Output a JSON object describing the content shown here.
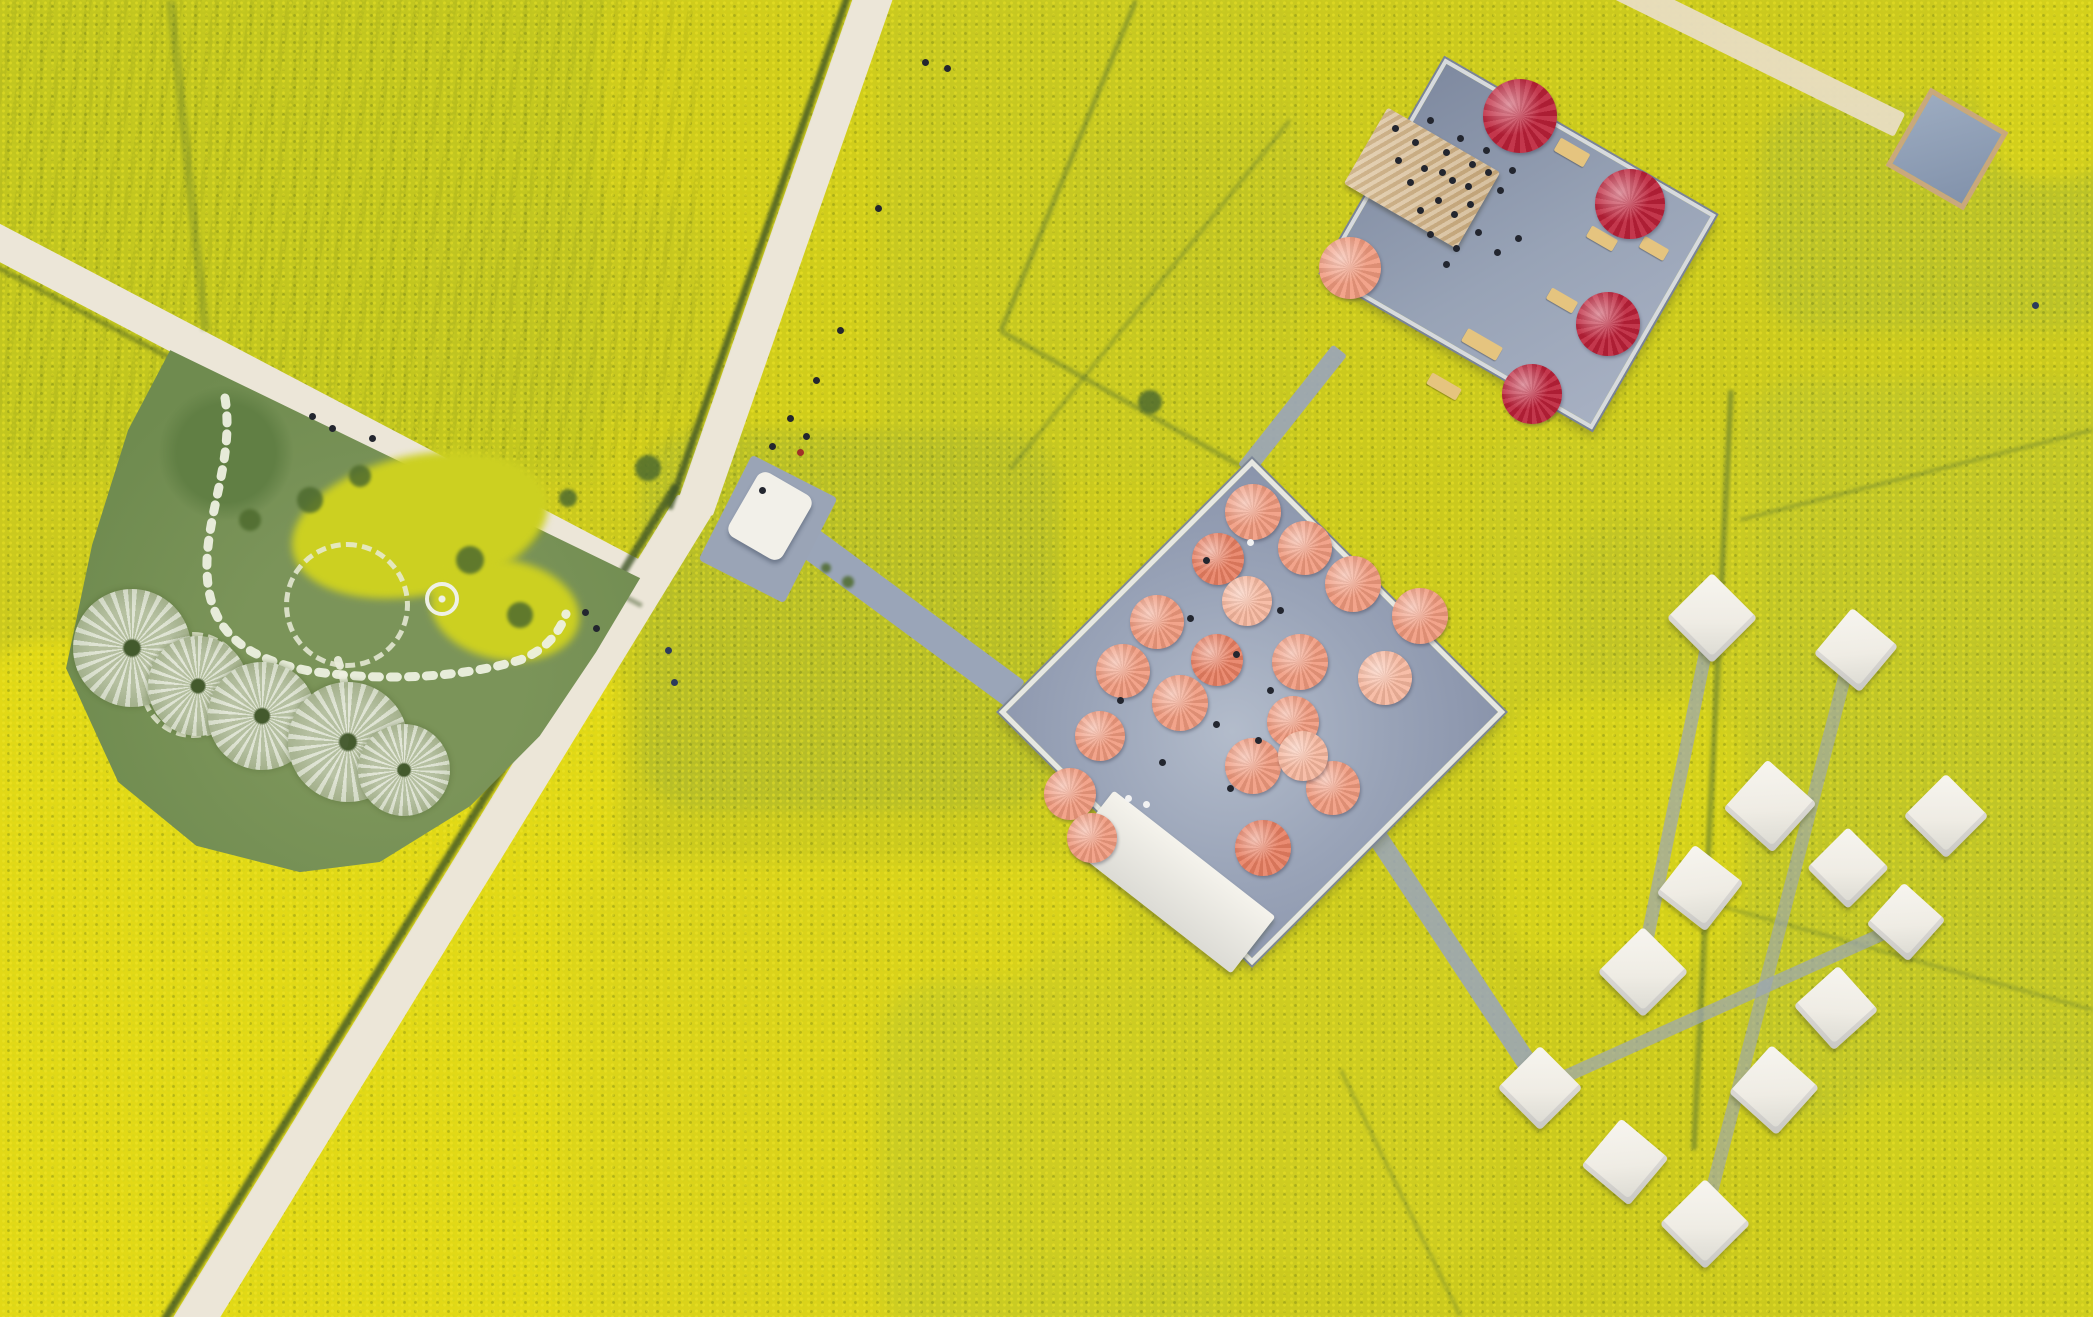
{
  "scene": {
    "description": "Aerial drone view of blooming yellow rapeseed flower fields crossed by a cream country road; a blue-gray viewing platform covered with salmon-pink umbrellas sits in the middle, a second platform with crimson umbrellas and a tan-roofed pavilion sits upper right, white square tents are scattered lower right, and a green spiral garden with pale dandelion-like canopy sculptures and stepping-stone paths lies on the left."
  },
  "palette": {
    "field_base": "#cbc91e",
    "field_bright": "#e4da16",
    "field_olive": "#b4bc2a",
    "road": "#ece6d8",
    "road_tan": "#e8ddc2",
    "boardwalk": "#9aa5b8",
    "ditch": "#3f5526",
    "boundary": "#5a7430",
    "deck_gray": "#9aa4b8",
    "garden_green": "#6f8b4f",
    "salmon": "#f09a7e",
    "salmon_light": "#f6b79e",
    "salmon_deep": "#e87f62",
    "crimson": "#bc2038",
    "tan_roof": "#d3b791",
    "tent_white": "#f2efe8",
    "dark": "#23262f",
    "navy": "#2c3a5c",
    "red": "#a03028",
    "white": "#f2f2f2"
  },
  "features": {
    "central_platform": {
      "shape": "rotated square deck",
      "deck_color": "#9aa4b8",
      "umbrella_count": 20,
      "umbrella_color": "salmon"
    },
    "upper_platform": {
      "shape": "rotated rectangle deck",
      "umbrella_count": 5,
      "umbrella_colors": [
        "crimson",
        "salmon"
      ],
      "pavilion_roof": "tan",
      "has_crowd": true
    },
    "spiral_garden": {
      "canopy_sculptures": 5,
      "stone_rings": 2,
      "stepping_stone_paths": 2,
      "flower_patches": 2
    },
    "tents": {
      "count": 13,
      "color": "white"
    },
    "roads": {
      "count": 3,
      "surface": "cream"
    },
    "boardwalks": {
      "count": 7,
      "surface": "blue-gray"
    }
  },
  "render": {
    "walkways": [
      {
        "cx": 787,
        "cy": 245,
        "len": 562,
        "w": 38,
        "rot": 109.2,
        "c": "road",
        "z": 6,
        "nm": "road-main-upper"
      },
      {
        "cx": 442,
        "cy": 917,
        "len": 968,
        "w": 40,
        "rot": 121.5,
        "c": "road",
        "z": 6,
        "nm": "road-main-lower"
      },
      {
        "cx": 320,
        "cy": 411,
        "len": 746,
        "w": 34,
        "rot": 27.7,
        "c": "road",
        "z": 6,
        "nm": "road-west"
      },
      {
        "cx": 1757,
        "cy": 55,
        "len": 318,
        "w": 26,
        "rot": 26.2,
        "c": "road_tan",
        "z": 6,
        "op": 0.95,
        "nm": "path-topright"
      },
      {
        "cx": 910,
        "cy": 617,
        "len": 261,
        "w": 32,
        "rot": 36.4,
        "c": "boardwalk",
        "z": 8,
        "nm": "boardwalk-entrance"
      },
      {
        "cx": 1292,
        "cy": 410,
        "len": 153,
        "w": 18,
        "rot": -51.6,
        "c": "boardwalk",
        "z": 8,
        "op": 0.92,
        "nm": "boardwalk-connector"
      },
      {
        "cx": 1447,
        "cy": 942,
        "len": 354,
        "w": 20,
        "rot": 56.5,
        "c": "boardwalk",
        "z": 8,
        "op": 0.88,
        "nm": "boardwalk-tents"
      },
      {
        "cx": 1676,
        "cy": 797,
        "len": 362,
        "w": 13,
        "rot": 101.5,
        "c": "boardwalk",
        "z": 8,
        "op": 0.7,
        "nm": "tent-path"
      },
      {
        "cx": 1776,
        "cy": 940,
        "len": 589,
        "w": 13,
        "rot": 104.5,
        "c": "boardwalk",
        "z": 8,
        "op": 0.62,
        "nm": "tent-path"
      },
      {
        "cx": 1725,
        "cy": 1004,
        "len": 395,
        "w": 13,
        "rot": -24.2,
        "c": "boardwalk",
        "z": 8,
        "op": 0.7,
        "nm": "tent-path"
      }
    ],
    "lines": [
      {
        "cx": 763,
        "cy": 237,
        "len": 575,
        "w": 7,
        "rot": 109.2,
        "c": "ditch",
        "op": 0.8,
        "nm": "road-ditch"
      },
      {
        "cx": 420,
        "cy": 903,
        "len": 980,
        "w": 8,
        "rot": 121.5,
        "c": "ditch",
        "op": 0.8,
        "nm": "road-ditch"
      },
      {
        "cx": 310,
        "cy": 431,
        "len": 750,
        "w": 5,
        "rot": 27.7,
        "c": "ditch",
        "op": 0.45,
        "nm": "road-ditch"
      },
      {
        "cx": 1068,
        "cy": 165,
        "len": 357,
        "w": 5,
        "rot": 112.2,
        "c": "boundary",
        "op": 0.5,
        "nm": "field-boundary"
      },
      {
        "cx": 1120,
        "cy": 398,
        "len": 275,
        "w": 5,
        "rot": 29.4,
        "c": "boundary",
        "op": 0.45,
        "nm": "field-boundary"
      },
      {
        "cx": 1150,
        "cy": 295,
        "len": 448,
        "w": 4,
        "rot": 128.7,
        "c": "boundary",
        "op": 0.4,
        "nm": "field-boundary"
      },
      {
        "cx": 1712,
        "cy": 770,
        "len": 761,
        "w": 6,
        "rot": 92.8,
        "c": "boundary",
        "op": 0.55,
        "nm": "field-boundary"
      },
      {
        "cx": 1916,
        "cy": 475,
        "len": 364,
        "w": 4,
        "rot": -14.3,
        "c": "boundary",
        "op": 0.4,
        "nm": "field-boundary"
      },
      {
        "cx": 1896,
        "cy": 955,
        "len": 408,
        "w": 4,
        "rot": 15.6,
        "c": "boundary",
        "op": 0.35,
        "nm": "field-boundary"
      },
      {
        "cx": 1400,
        "cy": 1193,
        "len": 275,
        "w": 4,
        "rot": 64.1,
        "c": "boundary",
        "op": 0.35,
        "nm": "field-boundary"
      },
      {
        "cx": 188,
        "cy": 165,
        "len": 332,
        "w": 9,
        "rot": 84,
        "c": "boundary",
        "op": 0.3,
        "nm": "tree-line"
      }
    ],
    "canopies": [
      {
        "x": 132,
        "y": 648,
        "d": 118
      },
      {
        "x": 198,
        "y": 686,
        "d": 100
      },
      {
        "x": 262,
        "y": 716,
        "d": 108
      },
      {
        "x": 348,
        "y": 742,
        "d": 120
      },
      {
        "x": 404,
        "y": 770,
        "d": 92
      }
    ],
    "rings": [
      {
        "x": 342,
        "y": 600,
        "d": 116
      },
      {
        "x": 188,
        "y": 680,
        "d": 96
      }
    ],
    "tents": [
      {
        "x": 1712,
        "y": 618,
        "s": 64,
        "rot": 45
      },
      {
        "x": 1856,
        "y": 650,
        "s": 60,
        "rot": 40
      },
      {
        "x": 1946,
        "y": 816,
        "s": 60,
        "rot": 45
      },
      {
        "x": 1770,
        "y": 806,
        "s": 66,
        "rot": 42
      },
      {
        "x": 1848,
        "y": 868,
        "s": 58,
        "rot": 45
      },
      {
        "x": 1906,
        "y": 922,
        "s": 56,
        "rot": 42
      },
      {
        "x": 1700,
        "y": 888,
        "s": 62,
        "rot": 38
      },
      {
        "x": 1643,
        "y": 972,
        "s": 64,
        "rot": 45
      },
      {
        "x": 1836,
        "y": 1008,
        "s": 60,
        "rot": 48
      },
      {
        "x": 1774,
        "y": 1090,
        "s": 64,
        "rot": 42
      },
      {
        "x": 1540,
        "y": 1088,
        "s": 60,
        "rot": 45
      },
      {
        "x": 1625,
        "y": 1162,
        "s": 62,
        "rot": 40
      },
      {
        "x": 1705,
        "y": 1224,
        "s": 64,
        "rot": 45
      }
    ],
    "umbrellas": [
      {
        "x": 1253,
        "y": 512,
        "d": 56,
        "c": "salmon"
      },
      {
        "x": 1305,
        "y": 548,
        "d": 54,
        "c": "salmon"
      },
      {
        "x": 1218,
        "y": 559,
        "d": 52,
        "c": "salmon_deep"
      },
      {
        "x": 1353,
        "y": 584,
        "d": 56,
        "c": "salmon"
      },
      {
        "x": 1420,
        "y": 616,
        "d": 56,
        "c": "salmon"
      },
      {
        "x": 1157,
        "y": 622,
        "d": 54,
        "c": "salmon"
      },
      {
        "x": 1247,
        "y": 601,
        "d": 50,
        "c": "salmon_light"
      },
      {
        "x": 1300,
        "y": 662,
        "d": 56,
        "c": "salmon"
      },
      {
        "x": 1217,
        "y": 660,
        "d": 52,
        "c": "salmon_deep"
      },
      {
        "x": 1123,
        "y": 671,
        "d": 54,
        "c": "salmon"
      },
      {
        "x": 1180,
        "y": 703,
        "d": 56,
        "c": "salmon"
      },
      {
        "x": 1385,
        "y": 678,
        "d": 54,
        "c": "salmon_light"
      },
      {
        "x": 1293,
        "y": 722,
        "d": 52,
        "c": "salmon"
      },
      {
        "x": 1253,
        "y": 766,
        "d": 56,
        "c": "salmon"
      },
      {
        "x": 1333,
        "y": 788,
        "d": 54,
        "c": "salmon"
      },
      {
        "x": 1303,
        "y": 756,
        "d": 50,
        "c": "salmon_light"
      },
      {
        "x": 1263,
        "y": 848,
        "d": 56,
        "c": "salmon_deep"
      },
      {
        "x": 1100,
        "y": 736,
        "d": 50,
        "c": "salmon"
      },
      {
        "x": 1070,
        "y": 794,
        "d": 52,
        "c": "salmon"
      },
      {
        "x": 1092,
        "y": 838,
        "d": 50,
        "c": "salmon"
      },
      {
        "x": 1520,
        "y": 116,
        "d": 74,
        "c": "crimson"
      },
      {
        "x": 1630,
        "y": 204,
        "d": 70,
        "c": "crimson"
      },
      {
        "x": 1608,
        "y": 324,
        "d": 64,
        "c": "crimson"
      },
      {
        "x": 1532,
        "y": 394,
        "d": 60,
        "c": "crimson"
      },
      {
        "x": 1350,
        "y": 268,
        "d": 62,
        "c": "salmon"
      }
    ],
    "benches": [
      {
        "x": 1572,
        "y": 152,
        "w": 34,
        "h": 15,
        "rot": 30
      },
      {
        "x": 1602,
        "y": 238,
        "w": 30,
        "h": 13,
        "rot": 30
      },
      {
        "x": 1562,
        "y": 300,
        "w": 30,
        "h": 13,
        "rot": 30
      },
      {
        "x": 1482,
        "y": 344,
        "w": 40,
        "h": 15,
        "rot": 30
      },
      {
        "x": 1444,
        "y": 386,
        "w": 34,
        "h": 13,
        "rot": 30
      },
      {
        "x": 1654,
        "y": 248,
        "w": 28,
        "h": 13,
        "rot": 30
      }
    ],
    "bushes": [
      {
        "x": 1150,
        "y": 402,
        "d": 24
      },
      {
        "x": 648,
        "y": 468,
        "d": 26
      },
      {
        "x": 568,
        "y": 498,
        "d": 18
      },
      {
        "x": 848,
        "y": 582,
        "d": 12
      },
      {
        "x": 826,
        "y": 568,
        "d": 10
      },
      {
        "x": 310,
        "y": 500,
        "d": 26
      },
      {
        "x": 360,
        "y": 476,
        "d": 22
      },
      {
        "x": 470,
        "y": 560,
        "d": 28
      },
      {
        "x": 520,
        "y": 615,
        "d": 26
      },
      {
        "x": 250,
        "y": 520,
        "d": 22
      }
    ],
    "people": [
      {
        "x": 925,
        "y": 62
      },
      {
        "x": 947,
        "y": 68
      },
      {
        "x": 878,
        "y": 208
      },
      {
        "x": 840,
        "y": 330
      },
      {
        "x": 816,
        "y": 380
      },
      {
        "x": 790,
        "y": 418
      },
      {
        "x": 772,
        "y": 446
      },
      {
        "x": 806,
        "y": 436
      },
      {
        "x": 762,
        "y": 490
      },
      {
        "x": 585,
        "y": 612
      },
      {
        "x": 596,
        "y": 628
      },
      {
        "x": 312,
        "y": 416
      },
      {
        "x": 332,
        "y": 428
      },
      {
        "x": 372,
        "y": 438
      },
      {
        "x": 668,
        "y": 650,
        "c": "navy"
      },
      {
        "x": 674,
        "y": 682,
        "c": "navy"
      },
      {
        "x": 2035,
        "y": 305,
        "c": "navy"
      },
      {
        "x": 800,
        "y": 452,
        "c": "red"
      },
      {
        "x": 1395,
        "y": 128
      },
      {
        "x": 1415,
        "y": 142
      },
      {
        "x": 1430,
        "y": 120
      },
      {
        "x": 1446,
        "y": 152
      },
      {
        "x": 1460,
        "y": 138
      },
      {
        "x": 1472,
        "y": 164
      },
      {
        "x": 1486,
        "y": 150
      },
      {
        "x": 1452,
        "y": 180
      },
      {
        "x": 1438,
        "y": 200
      },
      {
        "x": 1470,
        "y": 204
      },
      {
        "x": 1500,
        "y": 190
      },
      {
        "x": 1512,
        "y": 170
      },
      {
        "x": 1430,
        "y": 234
      },
      {
        "x": 1456,
        "y": 248
      },
      {
        "x": 1478,
        "y": 232
      },
      {
        "x": 1497,
        "y": 252
      },
      {
        "x": 1518,
        "y": 238
      },
      {
        "x": 1446,
        "y": 264
      },
      {
        "x": 1398,
        "y": 160
      },
      {
        "x": 1410,
        "y": 182
      },
      {
        "x": 1424,
        "y": 168
      },
      {
        "x": 1420,
        "y": 210
      },
      {
        "x": 1442,
        "y": 172
      },
      {
        "x": 1454,
        "y": 214
      },
      {
        "x": 1468,
        "y": 186
      },
      {
        "x": 1488,
        "y": 172
      },
      {
        "x": 1190,
        "y": 618
      },
      {
        "x": 1236,
        "y": 654
      },
      {
        "x": 1270,
        "y": 690
      },
      {
        "x": 1216,
        "y": 724
      },
      {
        "x": 1258,
        "y": 740
      },
      {
        "x": 1162,
        "y": 762
      },
      {
        "x": 1230,
        "y": 788
      },
      {
        "x": 1206,
        "y": 560
      },
      {
        "x": 1280,
        "y": 610
      },
      {
        "x": 1120,
        "y": 700
      },
      {
        "x": 1128,
        "y": 798,
        "c": "white"
      },
      {
        "x": 1146,
        "y": 804,
        "c": "white"
      },
      {
        "x": 1250,
        "y": 542,
        "c": "white"
      }
    ]
  }
}
